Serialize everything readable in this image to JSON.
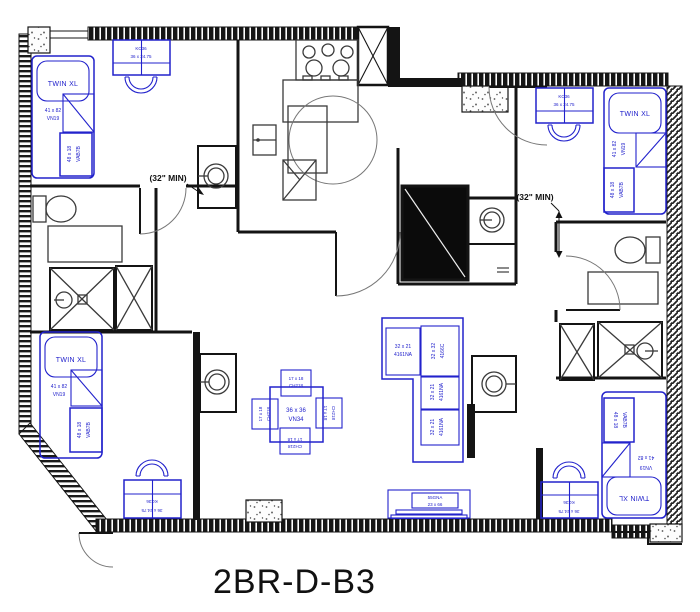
{
  "title": "2BR-D-B3",
  "colors": {
    "furniture": "#2222cc",
    "walls": "#141414",
    "fixtures": "#3a3a3a",
    "door_arc": "#777777"
  },
  "labels": {
    "bed_type": "TWIN XL",
    "bed_size": "41 x 82",
    "bed_code": "VN19",
    "dresser_size": "48 x 18",
    "dresser_code": "VAB7B",
    "desk_code": "KC36",
    "desk_size": "36 x 24.75",
    "table_size": "36 x 36",
    "table_code": "VN34",
    "chair_size": "17 x 18",
    "chair_code": "CH218",
    "sofa_seat_size": "32 x 21",
    "sofa_seat_code": "4161NA",
    "sofa_corner_size": "32 x 32",
    "sofa_corner_code": "4166C",
    "media_code": "55GNA",
    "media_size": "23 x 66",
    "clearance": "(32\" MIN)"
  }
}
